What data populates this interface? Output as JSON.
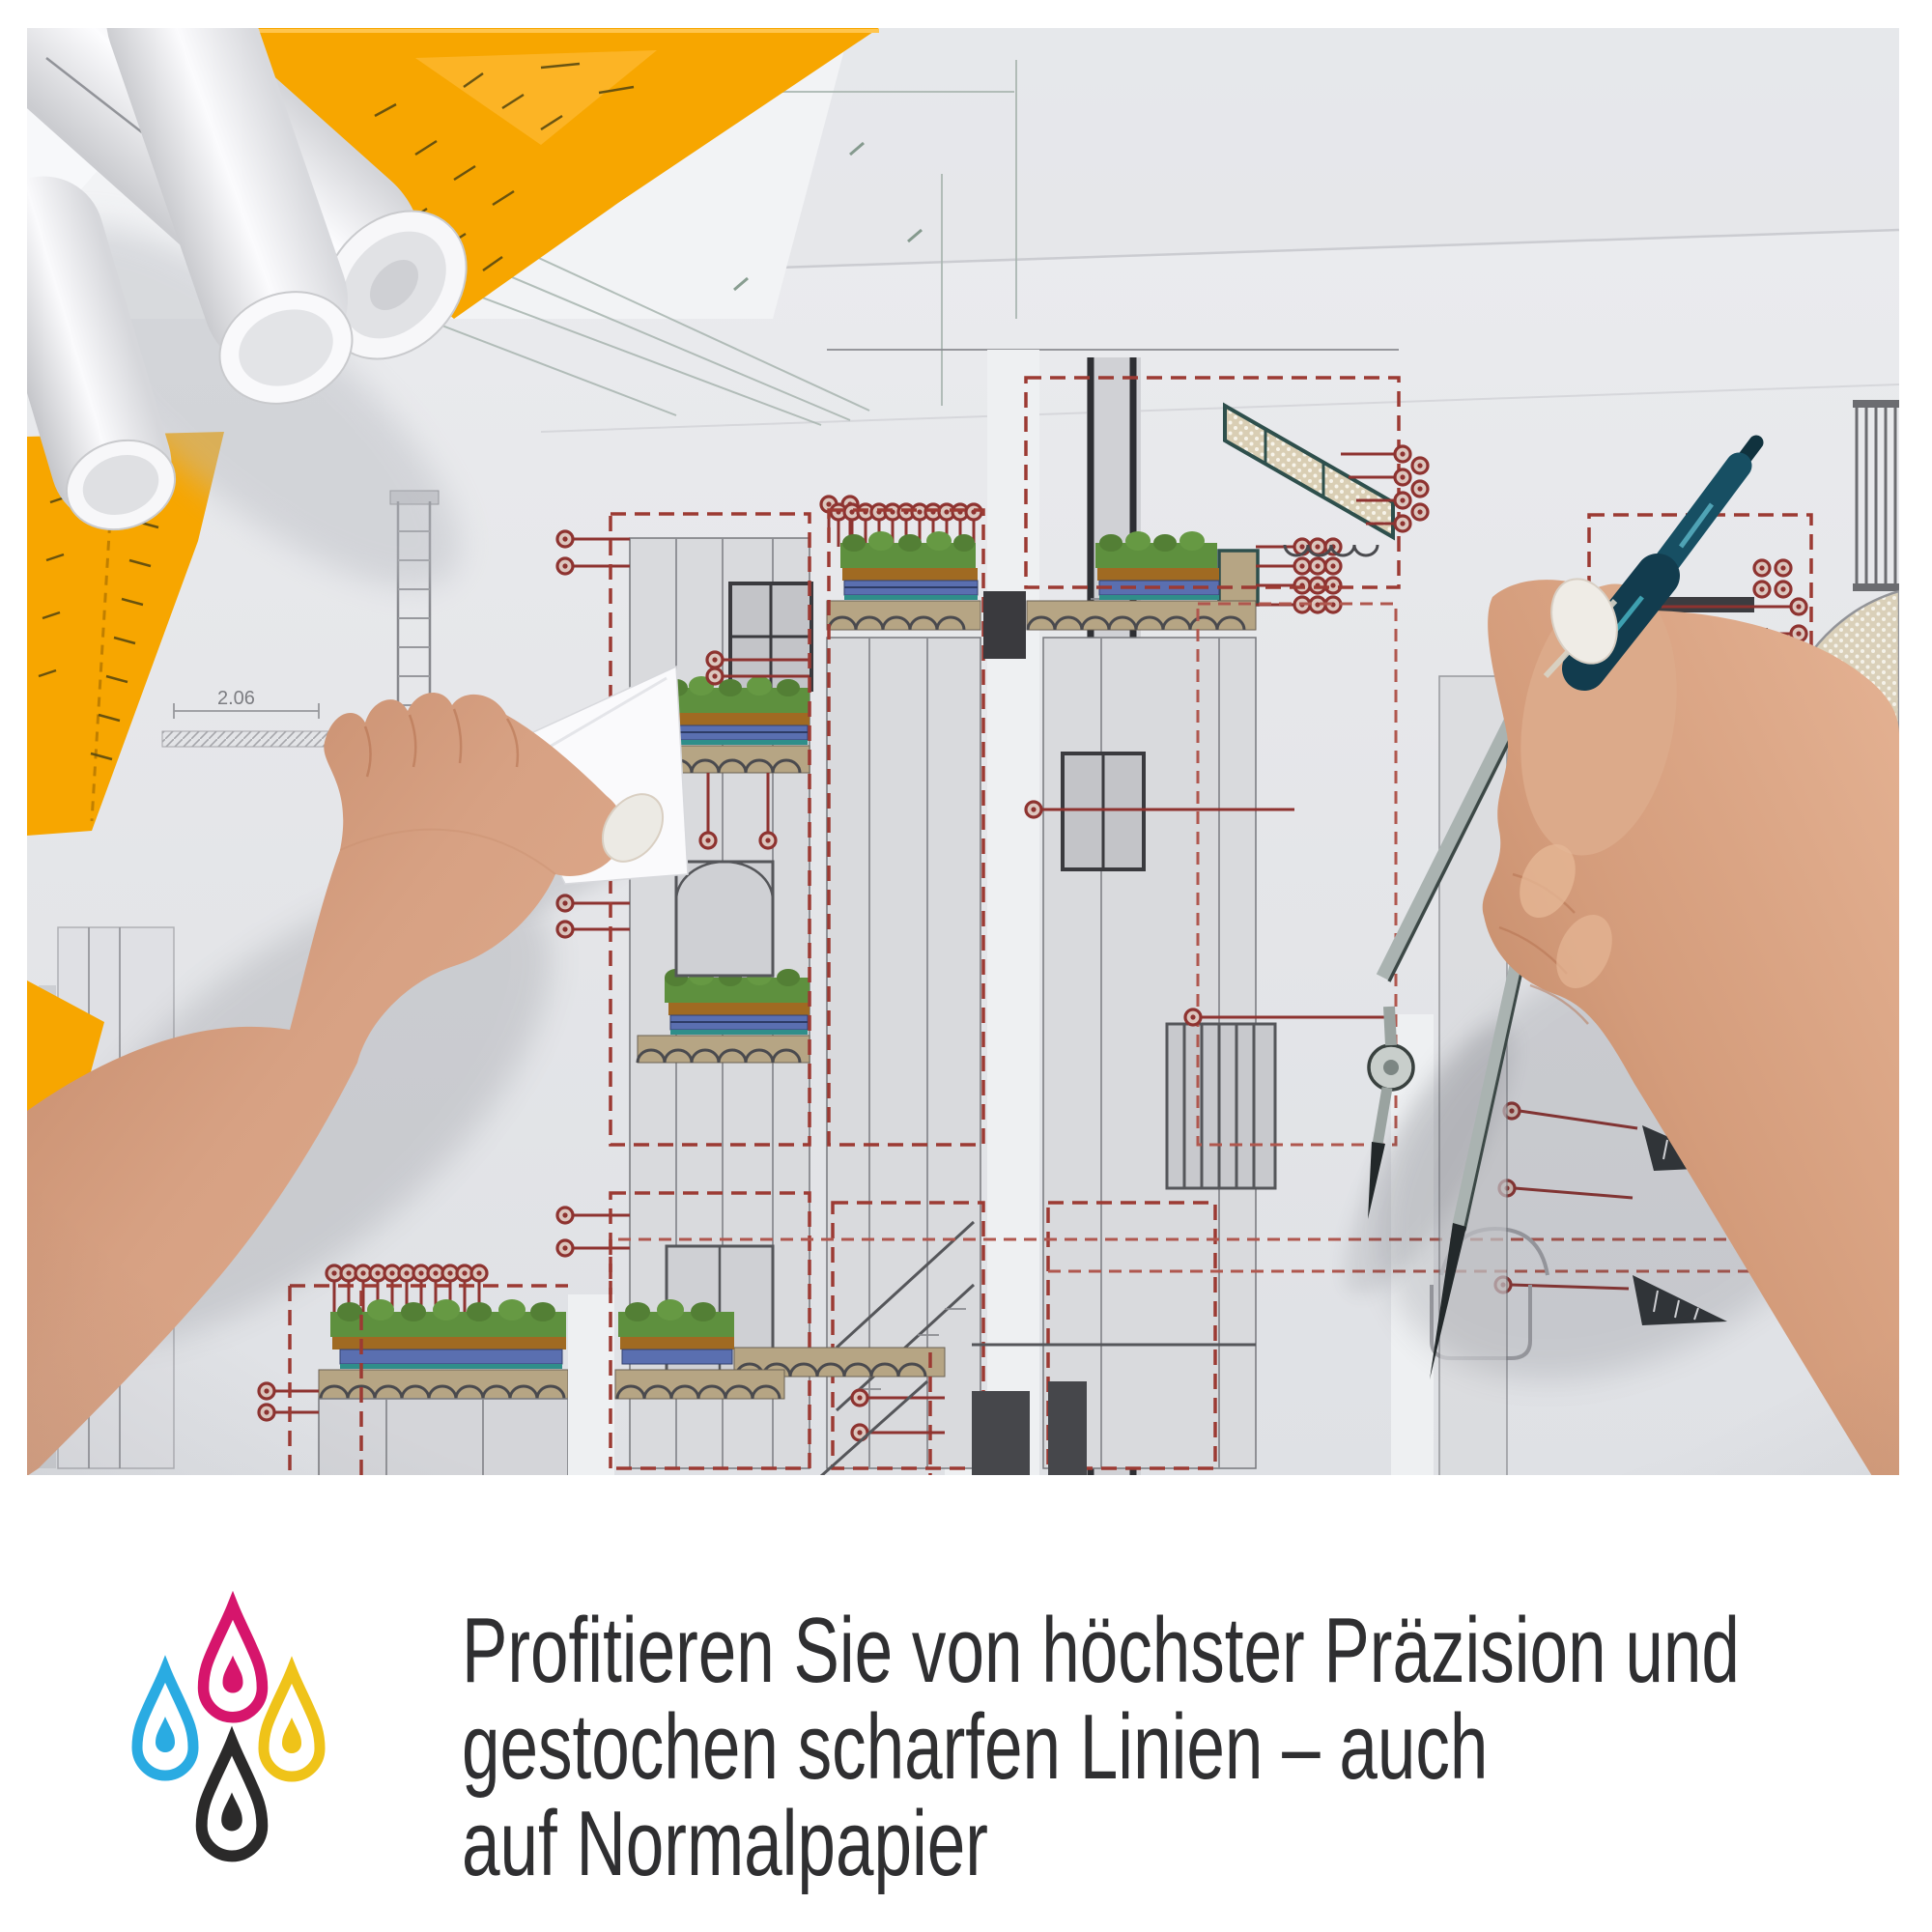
{
  "caption": {
    "lines": [
      "Profitieren Sie von höchster Präzision und",
      "gestochen scharfen Linien – auch",
      "auf Normalpapier"
    ],
    "color": "#2f2f31"
  },
  "icon": {
    "name": "cmyk-ink-drops",
    "drops": [
      {
        "name": "cyan",
        "color": "#2aabe2"
      },
      {
        "name": "magenta",
        "color": "#d6156c"
      },
      {
        "name": "yellow",
        "color": "#efc319"
      },
      {
        "name": "black",
        "color": "#2b2a2a"
      }
    ]
  },
  "photo": {
    "drawing_label": "2.06",
    "colors": {
      "set_square_orange": "#f7a600",
      "annotation_red": "#9c3a33",
      "roof_green": "#5e903e",
      "drainage_blue": "#5a6fb0",
      "compass_teal": "#174f63"
    }
  }
}
